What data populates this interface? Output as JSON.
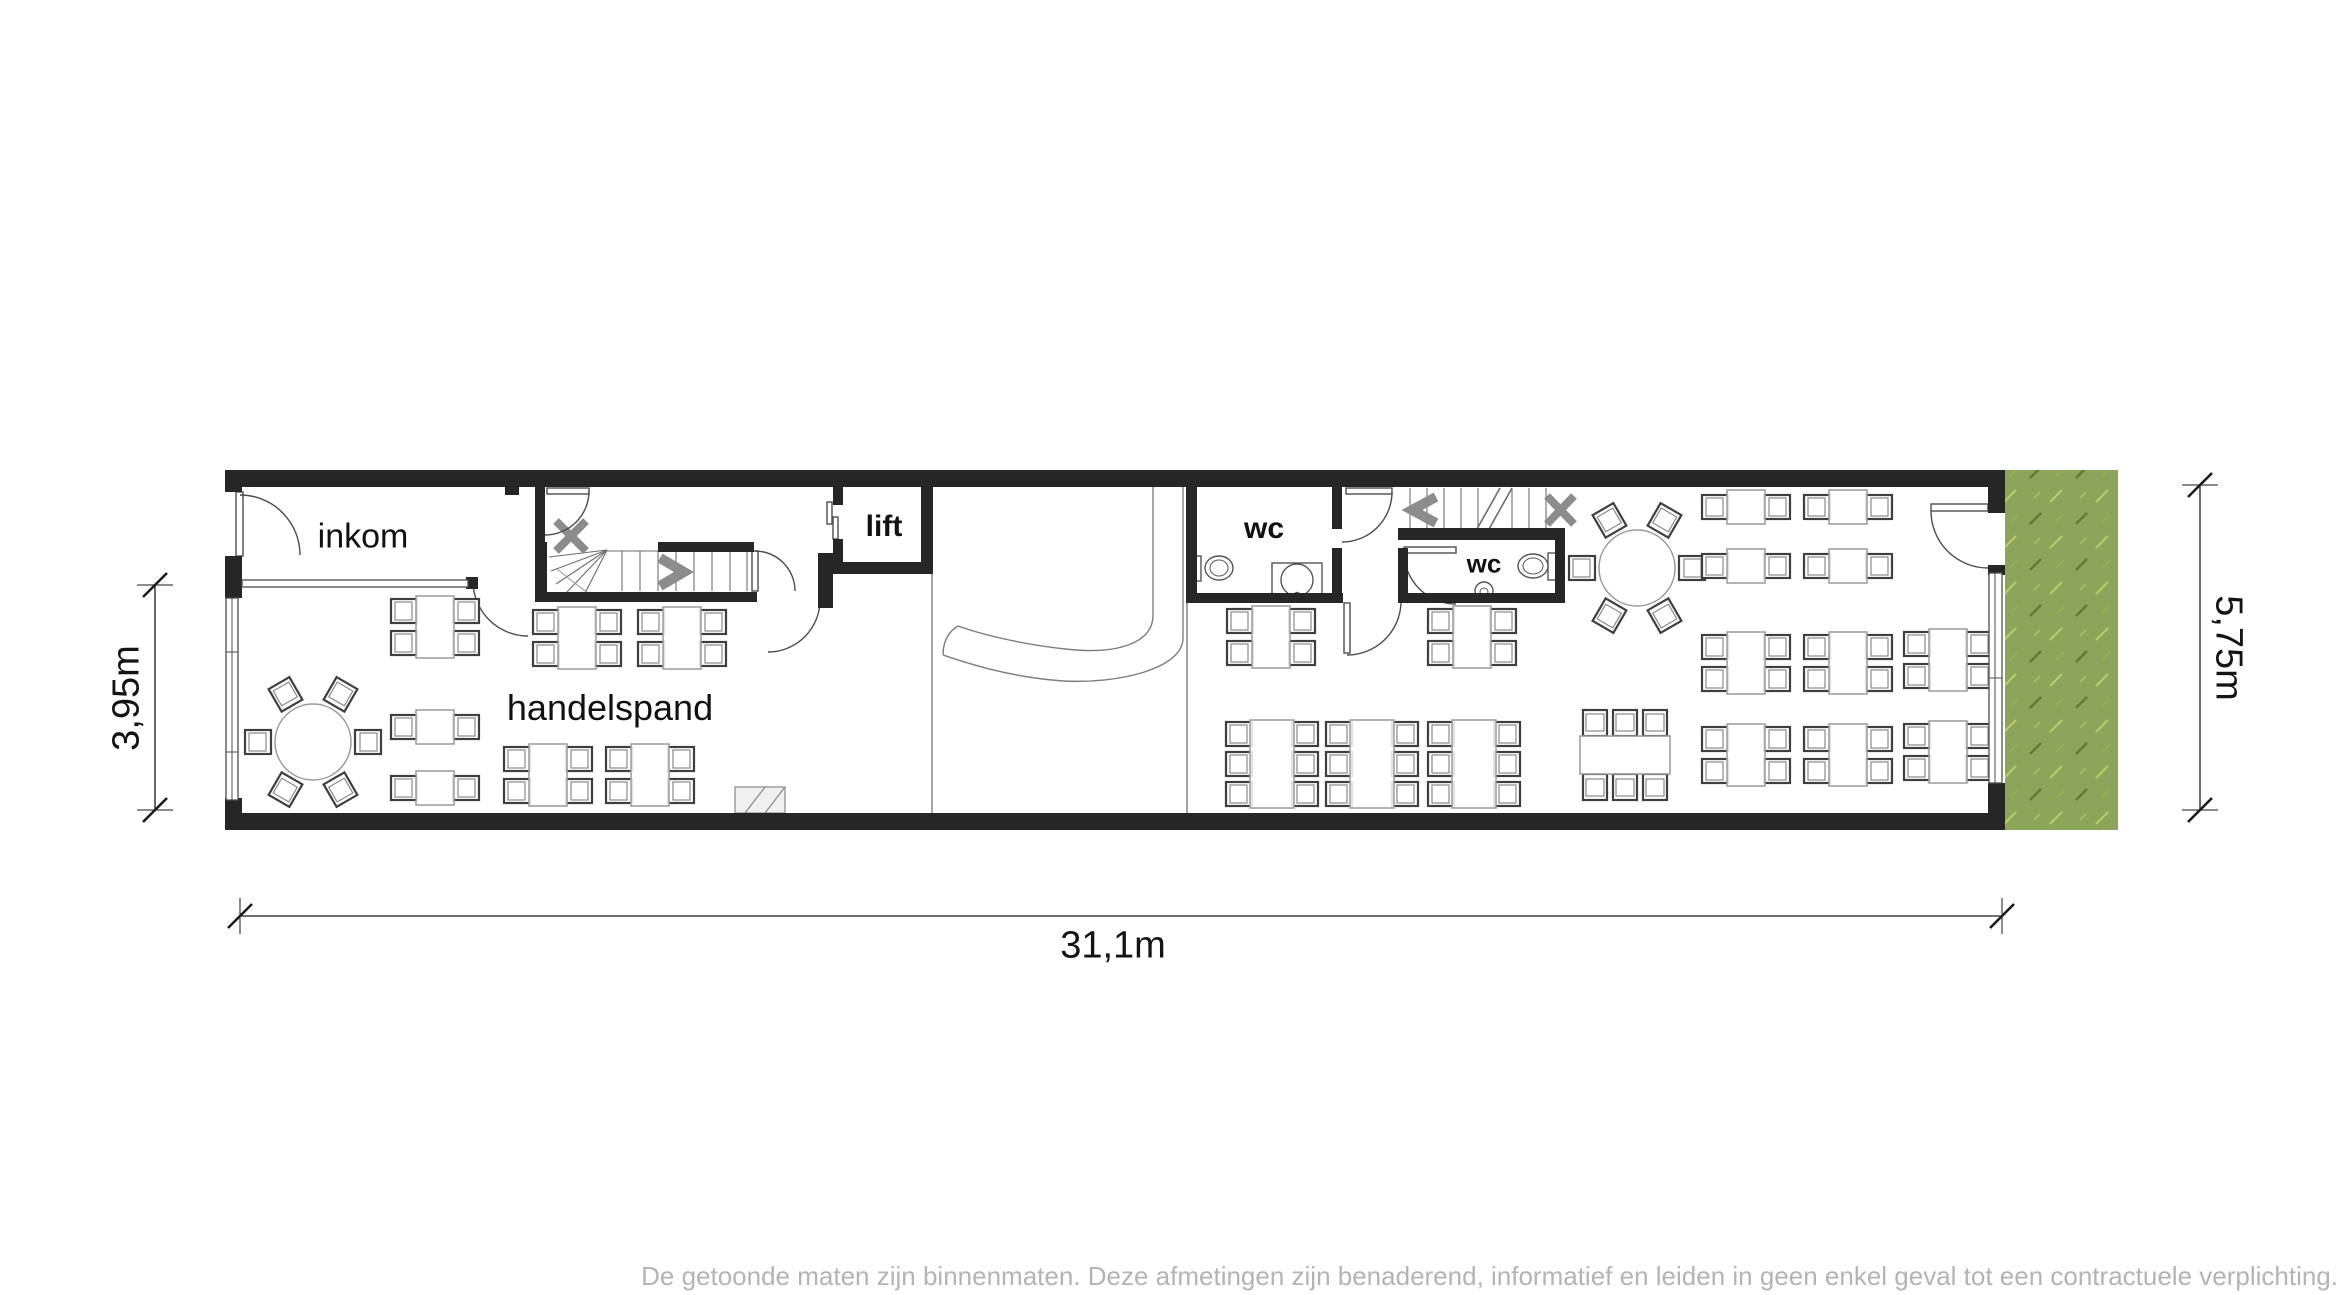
{
  "labels": {
    "inkom": "inkom",
    "lift": "lift",
    "wc_left": "wc",
    "wc_right": "wc",
    "handelspand": "handelspand"
  },
  "dimensions": {
    "total_width": "31,1m",
    "left_depth": "3,95m",
    "right_depth": "5,75m"
  },
  "footer": {
    "disclaimer": "De getoonde maten zijn binnenmaten. Deze afmetingen zijn benaderend, informatief en leiden in geen enkel geval tot een contractuele verplichting."
  },
  "colors": {
    "wall": "#262626",
    "line": "#4d4d4d",
    "stair_line": "#6e6e6e",
    "arrow_gray": "#8c8c8c",
    "chair_dark": "#3f3f3f",
    "chair_light": "#8a8a8a",
    "table_light": "#9a9a9a",
    "grass": "#8ca55b",
    "grass_dark": "#5e7a35",
    "grass_light": "#b9cc67",
    "disclaimer_text": "#b4b4b4",
    "dim_line": "#1a1a1a"
  },
  "furniture": [
    {
      "type": "round6",
      "x": 313,
      "y": 742
    },
    {
      "type": "table4",
      "x": 435,
      "y": 627
    },
    {
      "type": "table2",
      "x": 435,
      "y": 727
    },
    {
      "type": "table2",
      "x": 435,
      "y": 788
    },
    {
      "type": "table4",
      "x": 577,
      "y": 638
    },
    {
      "type": "table4",
      "x": 682,
      "y": 638
    },
    {
      "type": "table4",
      "x": 548,
      "y": 775
    },
    {
      "type": "table4",
      "x": 650,
      "y": 775
    },
    {
      "type": "ramp",
      "x": 760,
      "y": 800
    },
    {
      "type": "table4",
      "x": 1271,
      "y": 637
    },
    {
      "type": "table4",
      "x": 1472,
      "y": 637
    },
    {
      "type": "table6v",
      "x": 1272,
      "y": 764
    },
    {
      "type": "table6v",
      "x": 1372,
      "y": 764
    },
    {
      "type": "table6v",
      "x": 1474,
      "y": 764
    },
    {
      "type": "table6h",
      "x": 1625,
      "y": 755
    },
    {
      "type": "round6",
      "x": 1637,
      "y": 568
    },
    {
      "type": "table2",
      "x": 1746,
      "y": 507
    },
    {
      "type": "table2",
      "x": 1848,
      "y": 507
    },
    {
      "type": "table2",
      "x": 1746,
      "y": 566
    },
    {
      "type": "table2",
      "x": 1848,
      "y": 566
    },
    {
      "type": "table4",
      "x": 1746,
      "y": 663
    },
    {
      "type": "table4",
      "x": 1848,
      "y": 663
    },
    {
      "type": "table4",
      "x": 1746,
      "y": 755
    },
    {
      "type": "table4",
      "x": 1848,
      "y": 755
    },
    {
      "type": "table4",
      "x": 1948,
      "y": 660
    },
    {
      "type": "table4",
      "x": 1948,
      "y": 752
    }
  ]
}
